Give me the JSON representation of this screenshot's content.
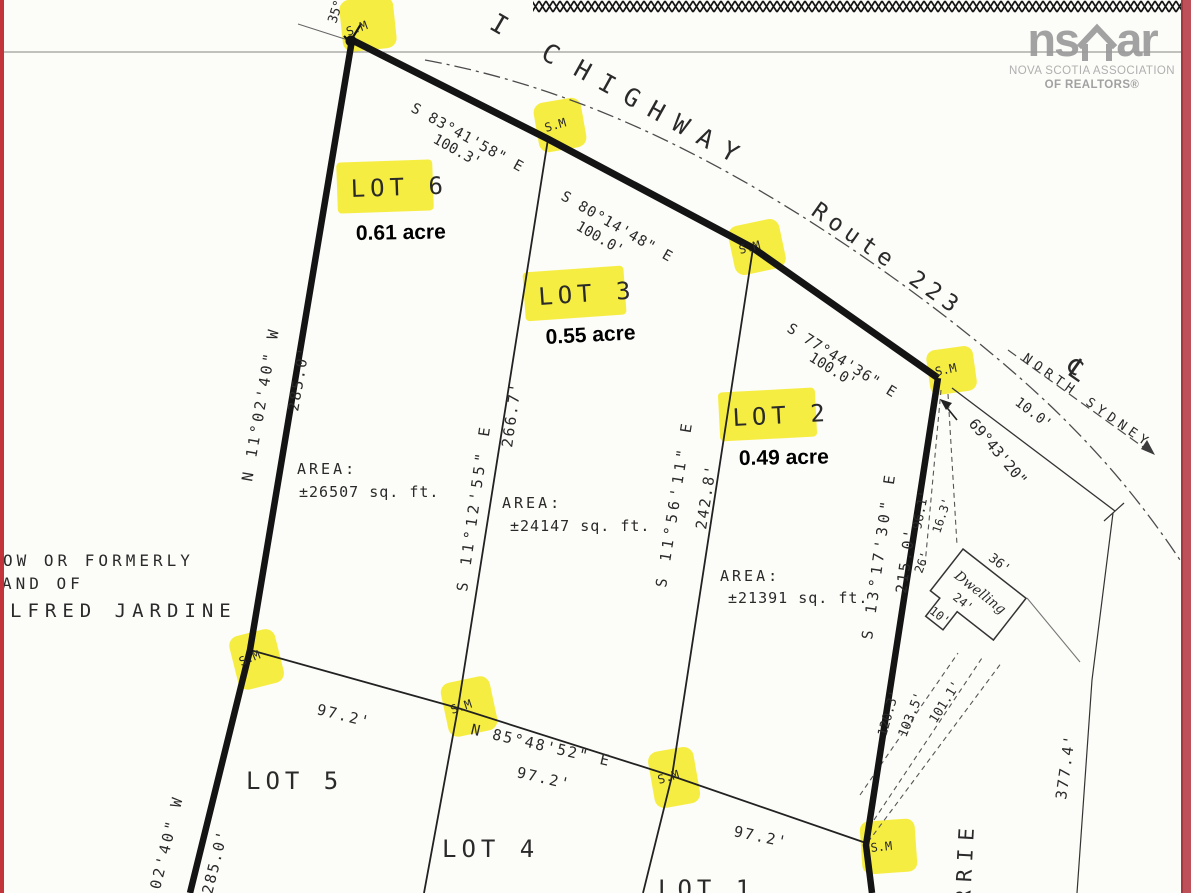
{
  "logo": {
    "ns": "ns",
    "ar": "ar",
    "assoc_line1": "NOVA SCOTIA ASSOCIATION",
    "assoc_line2": "OF REALTORS®"
  },
  "highway": {
    "name_prefix": "I C",
    "name": "HIGHWAY",
    "route": "Route 223",
    "centerline": "℄",
    "direction": "NORTH SYDNEY",
    "offset": "10.0'"
  },
  "marker_label": "S.M",
  "lots": {
    "lot6": {
      "label": "LOT 6",
      "acre": "0.61 acre",
      "area_label": "AREA:",
      "area": "±26507 sq. ft."
    },
    "lot3": {
      "label": "LOT 3",
      "acre": "0.55 acre",
      "area_label": "AREA:",
      "area": "±24147 sq. ft."
    },
    "lot2": {
      "label": "LOT 2",
      "acre": "0.49 acre",
      "area_label": "AREA:",
      "area": "±21391 sq. ft."
    },
    "lot5": {
      "label": "LOT 5"
    },
    "lot4": {
      "label": "LOT 4"
    },
    "lot1": {
      "label": "LOT 1"
    }
  },
  "bearings": {
    "front1": {
      "bearing": "S 83°41'58\" E",
      "distance": "100.3'"
    },
    "front2": {
      "bearing": "S 80°14'48\" E",
      "distance": "100.0'"
    },
    "front3": {
      "bearing": "S 77°44'36\" E",
      "distance": "100.0'"
    },
    "west": {
      "bearing": "N 11°02'40\" W",
      "distance": "285.0'"
    },
    "west_lower": {
      "bearing": "02'40\" W",
      "distance": "285.0'"
    },
    "div_63": {
      "bearing": "S 11°12'55\" E",
      "distance": "266.7'"
    },
    "div_32": {
      "bearing": "S 11°56'11\" E",
      "distance": "242.8'"
    },
    "east": {
      "bearing": "S 13°17'30\" E",
      "distance": "215.0'",
      "distance2": "96.1'"
    },
    "back": {
      "bearing": "N 85°48'52\" E",
      "d1": "97.2'",
      "d2": "97.2'",
      "d3": "97.2'"
    },
    "corner_angle": "69°43'20\"",
    "east_outer": "377.4'",
    "top_partial": "35°"
  },
  "dwelling": {
    "label": "Dwelling",
    "front": "36'",
    "side": "24'",
    "notch": "10'",
    "tie_a": "26'",
    "tie_b": "16.3'",
    "tie1": "120.3'",
    "tie2": "103.5'",
    "tie3": "101.1'"
  },
  "adjoiner": {
    "line1": "OW OR FORMERLY",
    "line2": "AND OF",
    "line3": "LFRED JARDINE",
    "right": "RRIE"
  }
}
